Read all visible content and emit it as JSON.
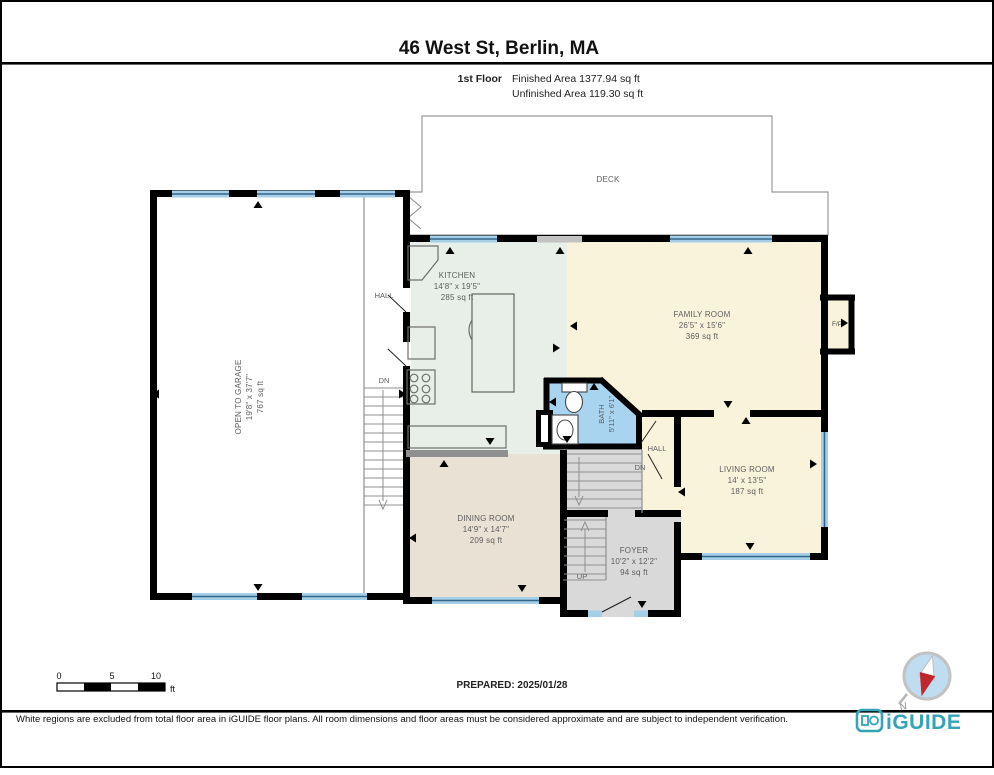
{
  "header": {
    "title": "46 West St, Berlin, MA",
    "floor": "1st Floor",
    "finished": "Finished Area 1377.94 sq ft",
    "unfinished": "Unfinished Area 119.30 sq ft"
  },
  "rooms": {
    "deck": {
      "name": "DECK"
    },
    "garage": {
      "name": "OPEN TO GARAGE",
      "dims": "19'8\" x 37'7\"",
      "area": "767 sq ft"
    },
    "kitchen": {
      "name": "KITCHEN",
      "dims": "14'8\" x 19'5\"",
      "area": "285 sq ft"
    },
    "family": {
      "name": "FAMILY ROOM",
      "dims": "26'5\" x 15'6\"",
      "area": "369 sq ft"
    },
    "bath": {
      "name": "BATH",
      "dims": "5'11\" x 6'1\""
    },
    "living": {
      "name": "LIVING ROOM",
      "dims": "14' x 13'5\"",
      "area": "187 sq ft"
    },
    "dining": {
      "name": "DINING ROOM",
      "dims": "14'9\" x 14'7\"",
      "area": "209 sq ft"
    },
    "foyer": {
      "name": "FOYER",
      "dims": "10'2\" x 12'2\"",
      "area": "94 sq ft"
    }
  },
  "labels": {
    "hall_west": "HALL",
    "hall_center": "HALL",
    "dn_west": "DN",
    "dn_center": "DN",
    "up": "UP",
    "fireplace": "F/P",
    "north": "N"
  },
  "scale_bar": {
    "t0": "0",
    "t5": "5",
    "t10": "10",
    "unit": "ft"
  },
  "prepared": "PREPARED: 2025/01/28",
  "footer": {
    "disclaimer": "White regions are excluded from total floor area in iGUIDE floor plans. All room dimensions and floor areas must be considered approximate and are subject to independent verification.",
    "brand": "iGUIDE"
  },
  "colors": {
    "wall": "#000000",
    "kitchen": "#e7efe8",
    "cream": "#faf3dc",
    "dining": "#e9e1d3",
    "gray_area": "#d9d9d9",
    "bath": "#a9d4f0",
    "window_light": "#a4cfe6",
    "window_dark": "#33658c",
    "brand_teal": "#35a3b8",
    "compass_red": "#c0272d"
  }
}
